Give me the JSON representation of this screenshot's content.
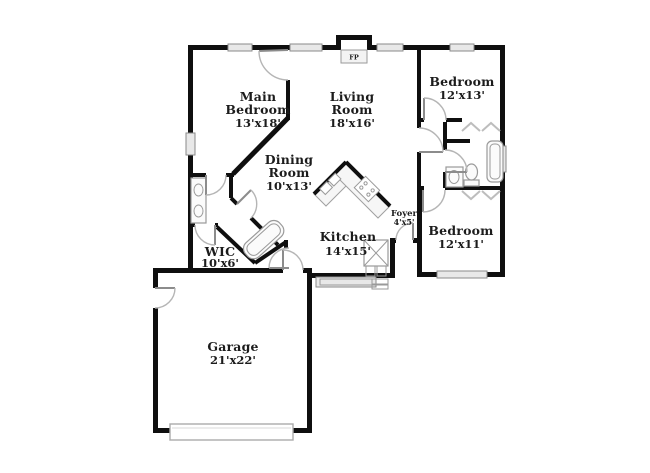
{
  "plan": {
    "fireplace": {
      "label": "FP"
    },
    "rooms": {
      "main_bedroom": {
        "lines": [
          "Main",
          "Bedroom",
          "13'x18'"
        ]
      },
      "living_room": {
        "lines": [
          "Living",
          "Room",
          "18'x16'"
        ]
      },
      "bedroom_top_right": {
        "lines": [
          "Bedroom",
          "12'x13'"
        ]
      },
      "dining_room": {
        "lines": [
          "Dining",
          "Room",
          "10'x13'"
        ]
      },
      "kitchen": {
        "lines": [
          "Kitchen",
          "14'x15'"
        ]
      },
      "foyer": {
        "lines": [
          "Foyer",
          "4'x5'"
        ]
      },
      "bedroom_bottom_right": {
        "lines": [
          "Bedroom",
          "12'x11'"
        ]
      },
      "wic": {
        "lines": [
          "WIC",
          "10'x6'"
        ]
      },
      "garage": {
        "lines": [
          "Garage",
          "21'x22'"
        ]
      }
    },
    "colors": {
      "wall": "#0f0f0f",
      "window_fill": "#e8e8e8",
      "fixture_stroke": "#9a9a9a",
      "door_arc": "#b5b5b5"
    }
  }
}
